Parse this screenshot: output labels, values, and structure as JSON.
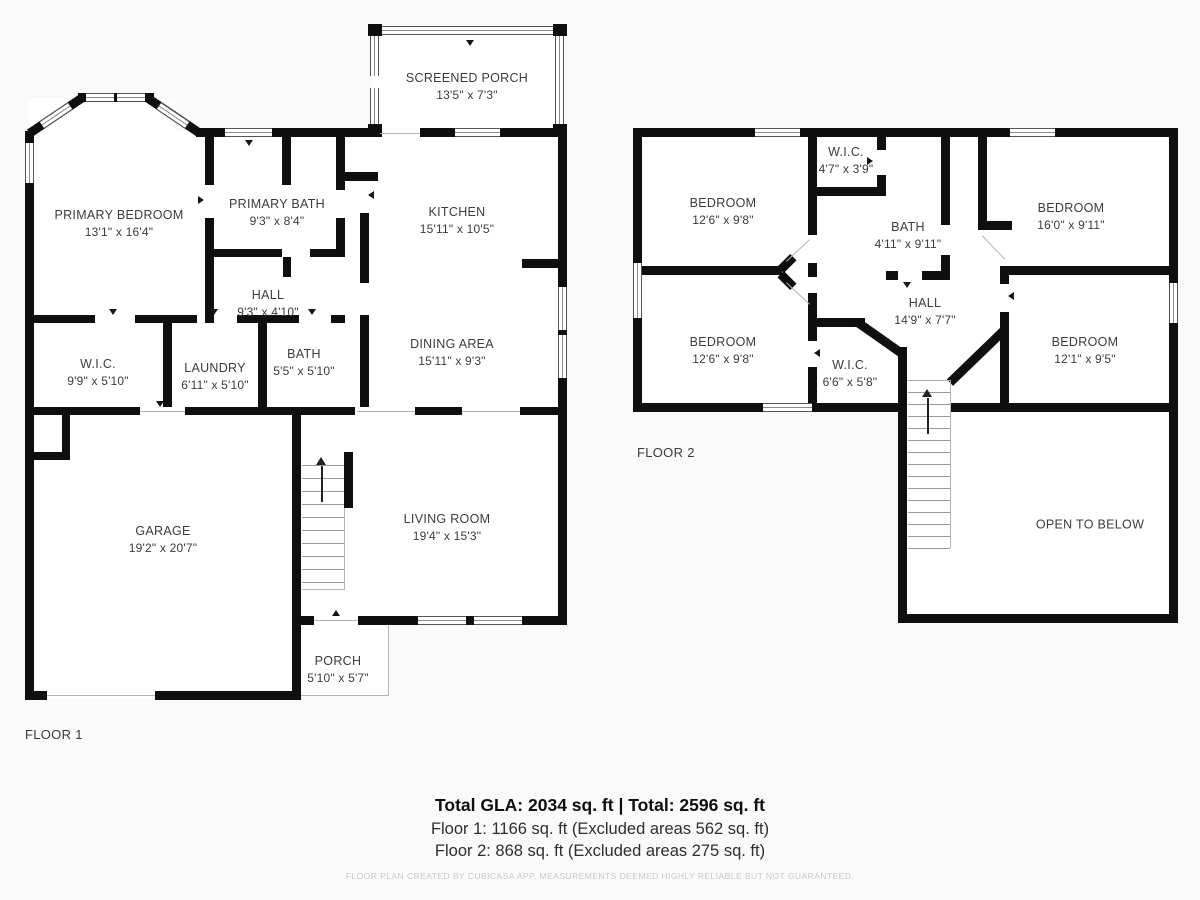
{
  "floor1": {
    "label": "FLOOR 1",
    "rooms": [
      {
        "name": "SCREENED PORCH",
        "dims": "13'5\" x 7'3\""
      },
      {
        "name": "PRIMARY BEDROOM",
        "dims": "13'1\" x 16'4\""
      },
      {
        "name": "PRIMARY BATH",
        "dims": "9'3\" x 8'4\""
      },
      {
        "name": "KITCHEN",
        "dims": "15'11\" x 10'5\""
      },
      {
        "name": "HALL",
        "dims": "9'3\" x 4'10\""
      },
      {
        "name": "W.I.C.",
        "dims": "9'9\" x 5'10\""
      },
      {
        "name": "LAUNDRY",
        "dims": "6'11\" x 5'10\""
      },
      {
        "name": "BATH",
        "dims": "5'5\" x 5'10\""
      },
      {
        "name": "DINING AREA",
        "dims": "15'11\" x 9'3\""
      },
      {
        "name": "GARAGE",
        "dims": "19'2\" x 20'7\""
      },
      {
        "name": "LIVING ROOM",
        "dims": "19'4\" x 15'3\""
      },
      {
        "name": "PORCH",
        "dims": "5'10\" x 5'7\""
      }
    ]
  },
  "floor2": {
    "label": "FLOOR 2",
    "rooms": [
      {
        "name": "BEDROOM",
        "dims": "12'6\" x 9'8\""
      },
      {
        "name": "W.I.C.",
        "dims": "4'7\" x 3'9\""
      },
      {
        "name": "BATH",
        "dims": "4'11\" x 9'11\""
      },
      {
        "name": "BEDROOM",
        "dims": "16'0\" x 9'11\""
      },
      {
        "name": "BEDROOM",
        "dims": "12'6\" x 9'8\""
      },
      {
        "name": "W.I.C.",
        "dims": "6'6\" x 5'8\""
      },
      {
        "name": "HALL",
        "dims": "14'9\" x 7'7\""
      },
      {
        "name": "BEDROOM",
        "dims": "12'1\" x 9'5\""
      },
      {
        "name": "OPEN TO BELOW",
        "dims": ""
      }
    ]
  },
  "summary": {
    "total_line": "Total GLA: 2034 sq. ft | Total: 2596 sq. ft",
    "floor1_line": "Floor 1: 1166 sq. ft (Excluded areas 562 sq. ft)",
    "floor2_line": "Floor 2: 868 sq. ft (Excluded areas 275 sq. ft)",
    "disclaimer": "FLOOR PLAN CREATED BY CUBICASA APP. MEASUREMENTS DEEMED HIGHLY RELIABLE BUT NOT GUARANTEED."
  },
  "colors": {
    "wall": "#0f0f0f",
    "window_frame": "#555555",
    "thin_line": "#b5b5b5",
    "text": "#3c3c3c",
    "disclaimer": "#c8c8c8",
    "background": "#fafafa",
    "interior": "#ffffff"
  }
}
